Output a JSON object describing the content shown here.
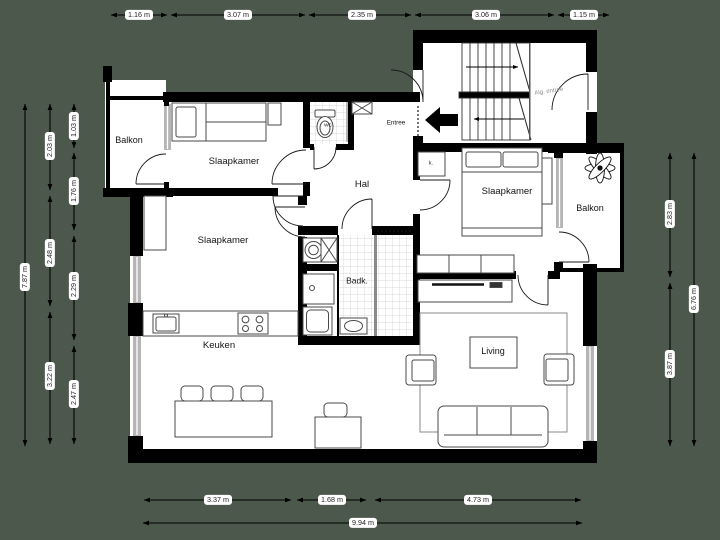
{
  "plan": {
    "type": "floor-plan",
    "language": "Dutch",
    "colors": {
      "background": "#4d584d",
      "floor": "#ffffff",
      "wall": "#000000",
      "window": "#b5b5b5",
      "tile_line": "#cccccc",
      "muted_label": "#8f8f8f",
      "dim_text": "#1f1f1f",
      "dim_label_bg": "#ffffff"
    }
  },
  "rooms": {
    "balkon_left": "Balkon",
    "slaapkamer_top_left": "Slaapkamer",
    "slaapkamer_mid_left": "Slaapkamer",
    "slaapkamer_right": "Slaapkamer",
    "hal": "Hal",
    "entree": "Entree",
    "wc": "WC",
    "badkamer": "Badk.",
    "keuken": "Keuken",
    "living": "Living",
    "balkon_right": "Balkon",
    "kast": "k.",
    "alg_entree": "Alg. entree"
  },
  "dimensions": {
    "top": [
      "1.16 m",
      "3.07 m",
      "2.35 m",
      "3.06 m",
      "1.15 m"
    ],
    "left_outer": "7.87 m",
    "left_mid": [
      "2.03 m",
      "2.48 m",
      "3.22 m"
    ],
    "left_inner": [
      "1.03 m",
      "1.76 m",
      "2.29 m",
      "2.47 m"
    ],
    "right_inner": [
      "2.83 m",
      "3.87 m"
    ],
    "right_outer": "6.76 m",
    "bottom": [
      "3.37 m",
      "1.68 m",
      "4.73 m"
    ],
    "bottom_total": "9.94 m"
  },
  "icons": {
    "entrance_arrow": "entrance-direction-arrow",
    "plant": "balcony-plant",
    "stairs": "staircase-two-flights"
  }
}
